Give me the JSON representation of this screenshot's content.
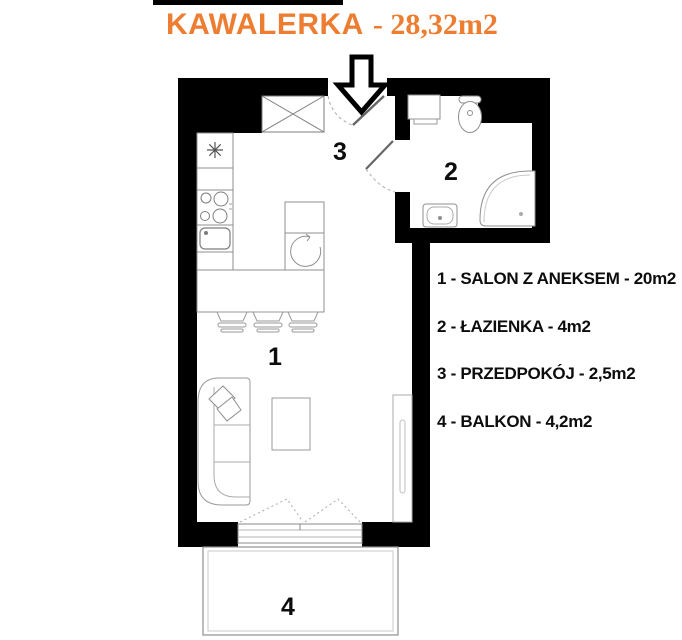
{
  "title": {
    "main": "KAWALERKA",
    "area": "- 28,32m2"
  },
  "rooms": {
    "salon": {
      "number": "1"
    },
    "lazienka": {
      "number": "2"
    },
    "przedpokoj": {
      "number": "3"
    },
    "balkon": {
      "number": "4"
    }
  },
  "legend": {
    "items": [
      {
        "number": "1",
        "name": "SALON Z ANEKSEM",
        "area": "20m2",
        "text": "1 - SALON Z ANEKSEM - 20m2"
      },
      {
        "number": "2",
        "name": "ŁAZIENKA",
        "area": "4m2",
        "text": "2 - ŁAZIENKA - 4m2"
      },
      {
        "number": "3",
        "name": "PRZEDPOKÓJ",
        "area": "2,5m2",
        "text": "3 - PRZEDPOKÓJ - 2,5m2"
      },
      {
        "number": "4",
        "name": "BALKON",
        "area": "4,2m2",
        "text": "4 - BALKON - 4,2m2"
      }
    ]
  },
  "colors": {
    "accent": "#ED7D31",
    "wall": "#000000",
    "furniture_line": "#8f8f8f",
    "text": "#0d0d0d"
  }
}
